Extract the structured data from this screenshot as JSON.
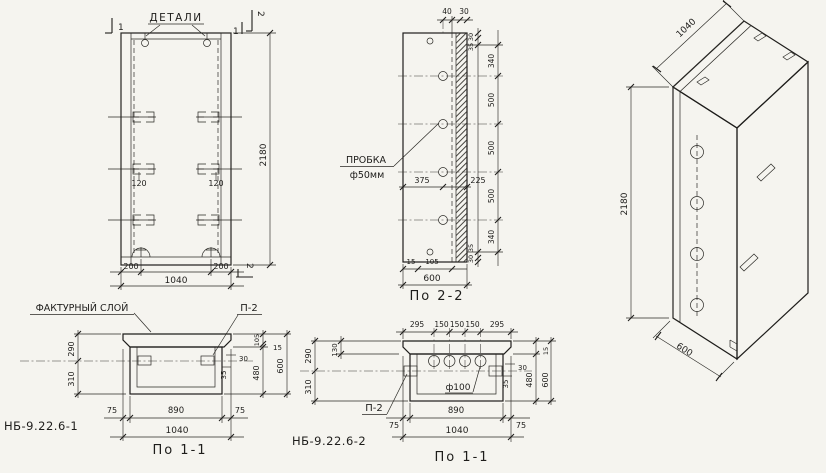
{
  "page": {
    "background": "#f5f4ef",
    "ink": "#1e1d1b"
  },
  "labels": {
    "details": "ДЕТАЛИ",
    "plug_name": "ПРОБКА",
    "plug_size": "ф50мм",
    "textured_layer": "ФАКТУРНЫЙ СЛОЙ",
    "anchor_ref": "П-2",
    "hole_ref": "ф100",
    "section_2_2": "По 2-2",
    "section_1_1": "По 1-1",
    "mark_1": "НБ-9.22.6-1",
    "mark_2": "НБ-9.22.6-2",
    "cut_1": "1",
    "cut_2": "2"
  },
  "front_view": {
    "height": "2180",
    "anchor_inset": "120",
    "edge_offset": "200",
    "width": "1040"
  },
  "side_section": {
    "top_dims": [
      "40",
      "30"
    ],
    "edge_dims_top": [
      "30",
      "35"
    ],
    "height_chain": [
      "340",
      "500",
      "500",
      "500",
      "340"
    ],
    "edge_dims_bottom": [
      "35",
      "30"
    ],
    "hole_from_left": "375",
    "hole_from_right": "225",
    "bottom_dims": [
      "15",
      "105"
    ],
    "depth": "600"
  },
  "iso_view": {
    "width": "1040",
    "height": "2180",
    "depth": "600"
  },
  "section_1": {
    "front_layer": "290",
    "rib": "310",
    "anchor_a": "30",
    "anchor_b": "35",
    "layer_chain": [
      "105",
      "15",
      "480"
    ],
    "depth": "600",
    "bottom": [
      "75",
      "890",
      "75"
    ],
    "width": "1040"
  },
  "section_2": {
    "top_chain": [
      "295",
      "150",
      "150",
      "150",
      "295"
    ],
    "front_layer": "290",
    "layer_thk": "130",
    "rib": "310",
    "anchor_a": "30",
    "anchor_b": "35",
    "edge_small": "15",
    "cavity": "480",
    "depth": "600",
    "bottom": [
      "75",
      "890",
      "75"
    ],
    "width": "1040"
  }
}
